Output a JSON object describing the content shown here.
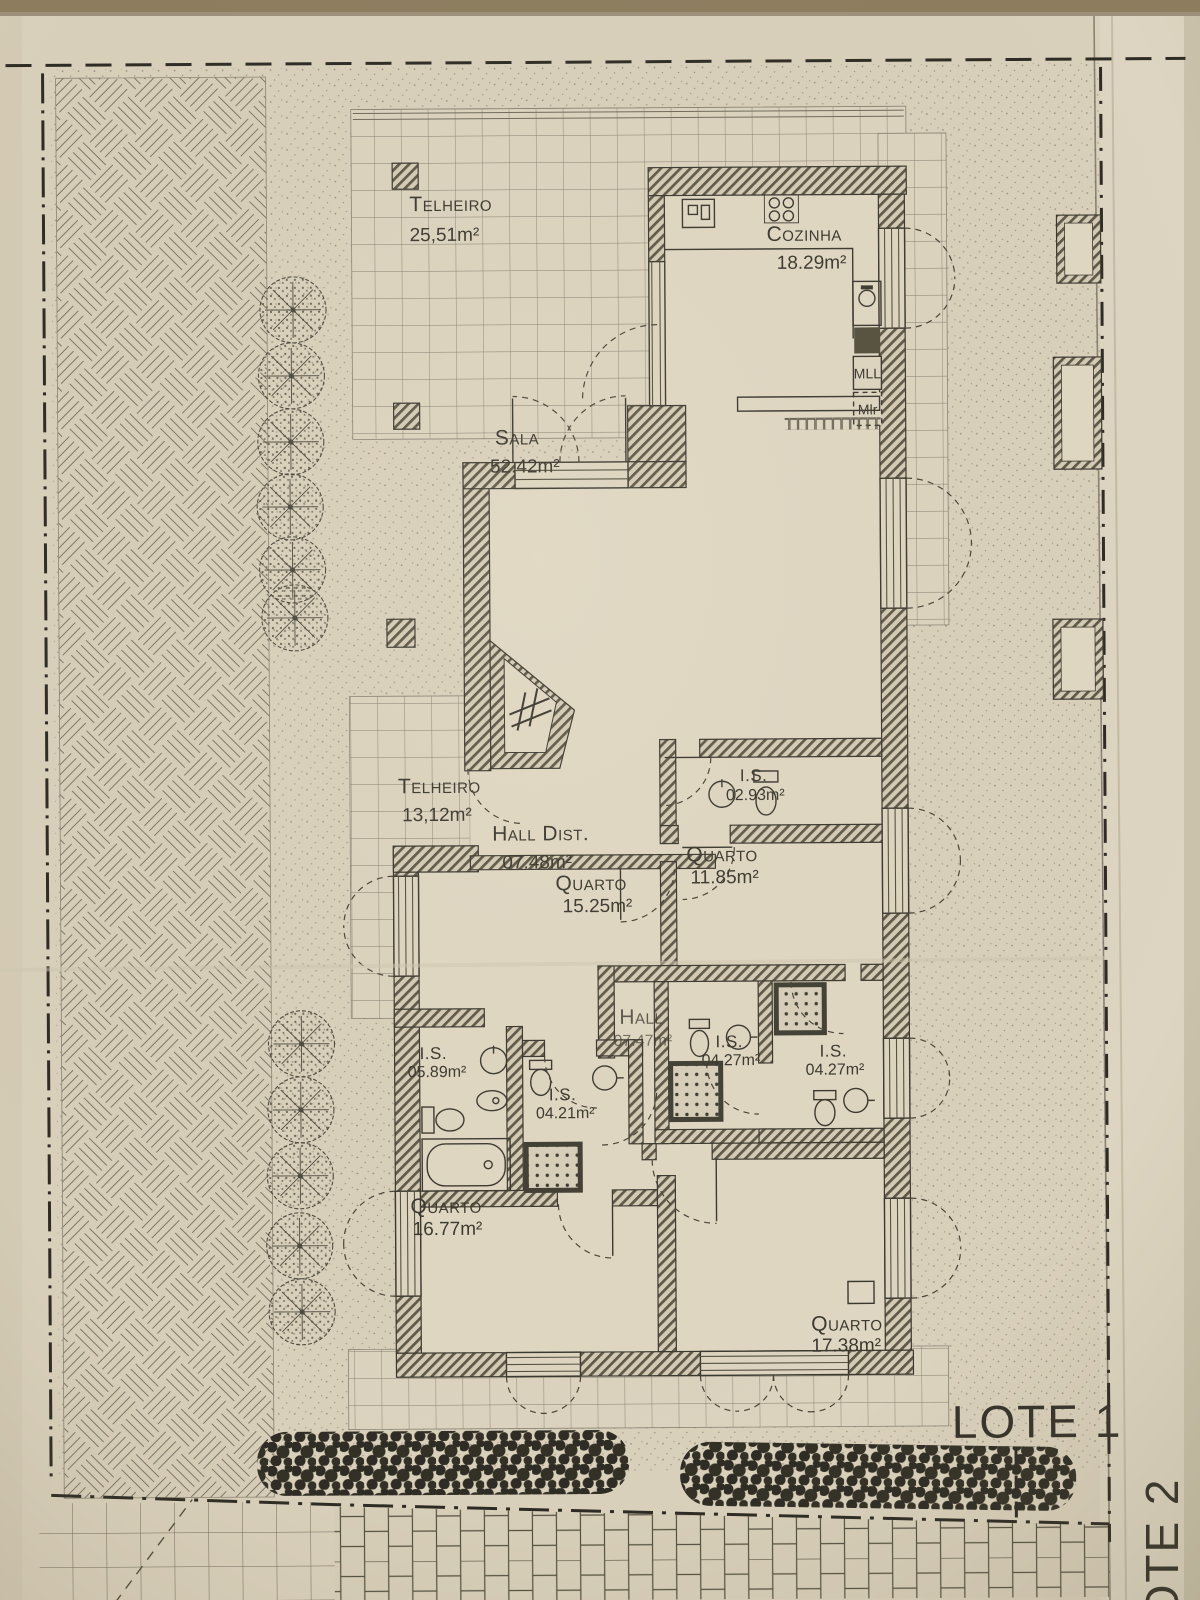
{
  "plan": {
    "lot_label": "LOTE 1",
    "adjacent_lot_label": "LOTE 2",
    "rooms": [
      {
        "name": "Telheiro",
        "area": "25,51m²"
      },
      {
        "name": "Cozinha",
        "area": "18.29m²"
      },
      {
        "name": "Sala",
        "area": "52.42m²"
      },
      {
        "name": "Telheiro",
        "area": "13,12m²"
      },
      {
        "name": "Hall Dist.",
        "area": "07.48m²"
      },
      {
        "name": "Quarto",
        "area": "15.25m²"
      },
      {
        "name": "I.S.",
        "area": "02.93m²"
      },
      {
        "name": "Quarto",
        "area": "11.85m²"
      },
      {
        "name": "Hall",
        "area": "07.47m²"
      },
      {
        "name": "I.S.",
        "area": "05.89m²"
      },
      {
        "name": "I.S.",
        "area": "04.21m²"
      },
      {
        "name": "I.S.",
        "area": "04.27m²"
      },
      {
        "name": "I.S.",
        "area": "04.27m²"
      },
      {
        "name": "Quarto",
        "area": "16.77m²"
      },
      {
        "name": "Quarto",
        "area": "17.38m²"
      }
    ],
    "appliances": {
      "mll": "MLL",
      "mlr": "Mlr"
    },
    "colors": {
      "paper": "#d9d0bb",
      "ink": "#3b382f",
      "hedge": "#2e2c24"
    }
  }
}
